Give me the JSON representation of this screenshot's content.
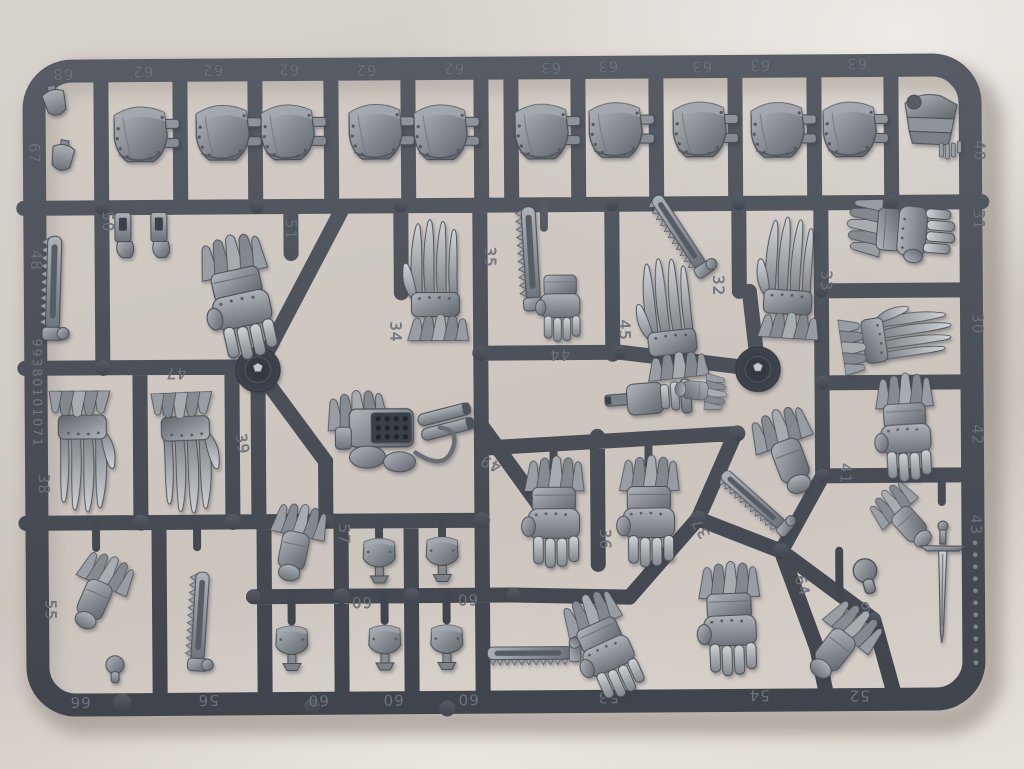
{
  "photo": {
    "background_wall_color": "#d6d0ca",
    "sprue_plastic_color": "#4c5159",
    "parts_plastic_color": "#888d94"
  },
  "sprue": {
    "serial_number": "99380101071",
    "labels": [
      {
        "n": "68",
        "x": 65,
        "y": 66,
        "r": 180
      },
      {
        "n": "62",
        "x": 145,
        "y": 64,
        "r": 180
      },
      {
        "n": "62",
        "x": 215,
        "y": 63,
        "r": 180
      },
      {
        "n": "62",
        "x": 291,
        "y": 63,
        "r": 180
      },
      {
        "n": "62",
        "x": 368,
        "y": 64,
        "r": 180
      },
      {
        "n": "62",
        "x": 456,
        "y": 63,
        "r": 180
      },
      {
        "n": "63",
        "x": 553,
        "y": 63,
        "r": 180
      },
      {
        "n": "63",
        "x": 610,
        "y": 62,
        "r": 180
      },
      {
        "n": "63",
        "x": 704,
        "y": 63,
        "r": 180
      },
      {
        "n": "63",
        "x": 762,
        "y": 62,
        "r": 180
      },
      {
        "n": "63",
        "x": 859,
        "y": 61,
        "r": 180
      },
      {
        "n": "67",
        "x": 31,
        "y": 150,
        "r": 90
      },
      {
        "n": "48",
        "x": 32,
        "y": 257,
        "r": 90
      },
      {
        "n": "38",
        "x": 38,
        "y": 481,
        "r": 90
      },
      {
        "n": "55",
        "x": 44,
        "y": 607,
        "r": 90
      },
      {
        "n": "40",
        "x": 976,
        "y": 154,
        "r": 90
      },
      {
        "n": "31",
        "x": 975,
        "y": 223,
        "r": 90
      },
      {
        "n": "30",
        "x": 973,
        "y": 327,
        "r": 90
      },
      {
        "n": "42",
        "x": 972,
        "y": 438,
        "r": 90
      },
      {
        "n": "43",
        "x": 970,
        "y": 528,
        "r": 90
      },
      {
        "n": "50",
        "x": 104,
        "y": 219,
        "r": 90
      },
      {
        "n": "51",
        "x": 287,
        "y": 228,
        "r": 90
      },
      {
        "n": "35",
        "x": 486,
        "y": 257,
        "r": 90
      },
      {
        "n": "34",
        "x": 391,
        "y": 331,
        "r": 90
      },
      {
        "n": "47",
        "x": 176,
        "y": 366,
        "r": 180
      },
      {
        "n": "39",
        "x": 237,
        "y": 443,
        "r": 80
      },
      {
        "n": "44",
        "x": 560,
        "y": 350,
        "r": 180
      },
      {
        "n": "45",
        "x": 620,
        "y": 331,
        "r": 90
      },
      {
        "n": "46",
        "x": 697,
        "y": 358,
        "r": 200
      },
      {
        "n": "32",
        "x": 714,
        "y": 287,
        "r": 90
      },
      {
        "n": "33",
        "x": 822,
        "y": 283,
        "r": 90
      },
      {
        "n": "49",
        "x": 492,
        "y": 459,
        "r": 205
      },
      {
        "n": "36",
        "x": 599,
        "y": 540,
        "r": 90
      },
      {
        "n": "37",
        "x": 704,
        "y": 527,
        "r": 240
      },
      {
        "n": "41",
        "x": 840,
        "y": 476,
        "r": 90
      },
      {
        "n": "57",
        "x": 338,
        "y": 533,
        "r": 90
      },
      {
        "n": "64",
        "x": 796,
        "y": 589,
        "r": 75
      },
      {
        "n": "65",
        "x": 857,
        "y": 607,
        "r": 160
      },
      {
        "n": "60",
        "x": 360,
        "y": 596,
        "r": 180
      },
      {
        "n": "60",
        "x": 466,
        "y": 594,
        "r": 180
      },
      {
        "n": "66",
        "x": 78,
        "y": 694,
        "r": 180
      },
      {
        "n": "56",
        "x": 206,
        "y": 693,
        "r": 180
      },
      {
        "n": "60",
        "x": 316,
        "y": 694,
        "r": 180
      },
      {
        "n": "60",
        "x": 391,
        "y": 694,
        "r": 180
      },
      {
        "n": "60",
        "x": 466,
        "y": 694,
        "r": 180
      },
      {
        "n": "53",
        "x": 606,
        "y": 693,
        "r": 180
      },
      {
        "n": "54",
        "x": 757,
        "y": 692,
        "r": 180
      },
      {
        "n": "52",
        "x": 857,
        "y": 693,
        "r": 180
      }
    ],
    "pips": {
      "x": 974,
      "y_start": 546,
      "step": 12,
      "count": 11
    }
  }
}
